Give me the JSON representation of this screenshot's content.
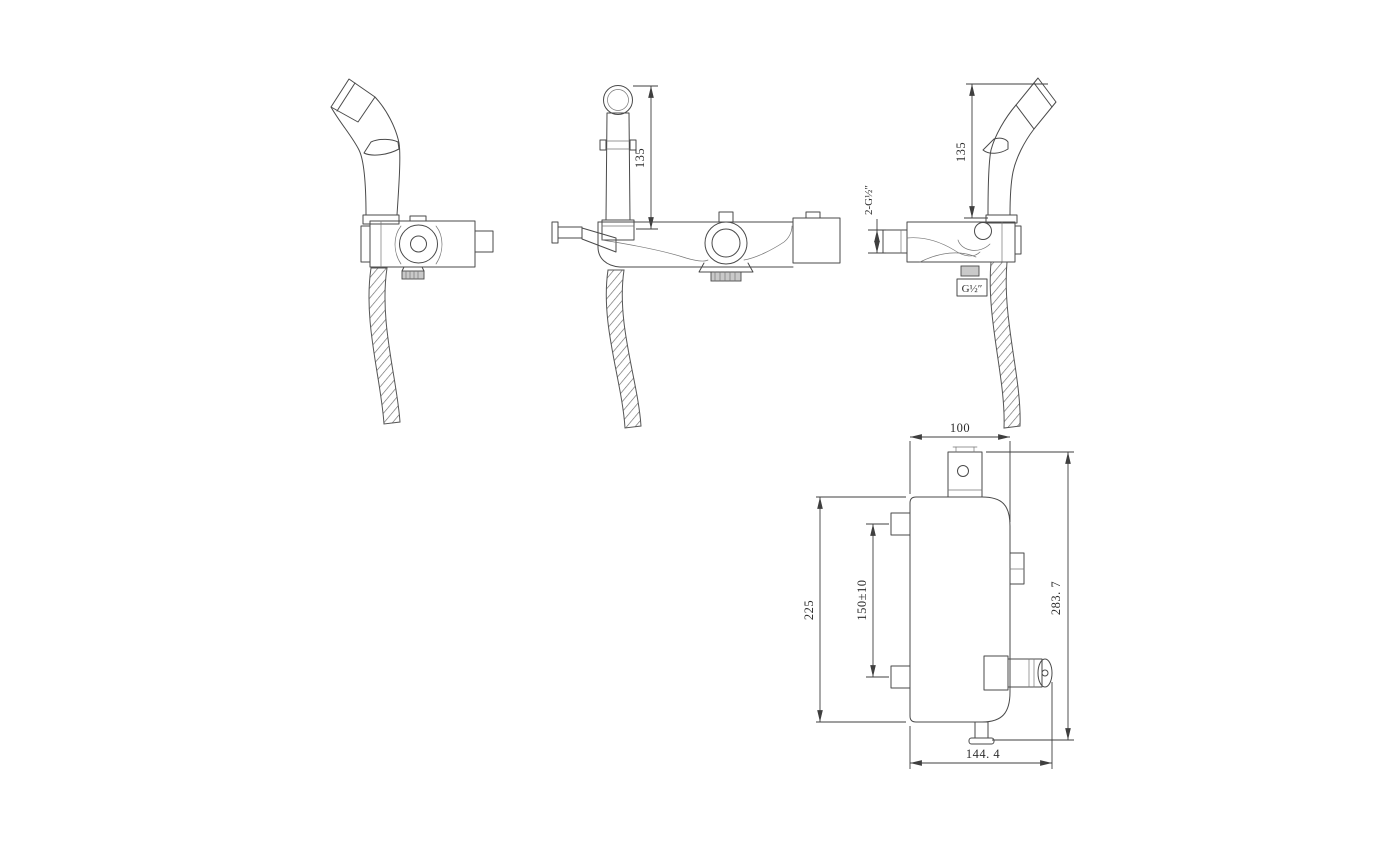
{
  "drawing": {
    "background": "#ffffff",
    "line_color": "#4a4a4a",
    "dim_color": "#3f3f3f",
    "shade_color": "#c9c9c9",
    "dim_labels": {
      "front_sprayer_height": "135",
      "side_sprayer_height": "135",
      "side_inlet_thread": "2-G½″",
      "side_outlet_thread": "G½″",
      "top_bracket_width": "100",
      "top_body_height": "225",
      "top_hole_spacing": "150±10",
      "top_overall_height": "283. 7",
      "top_overall_width": "144. 4"
    }
  }
}
